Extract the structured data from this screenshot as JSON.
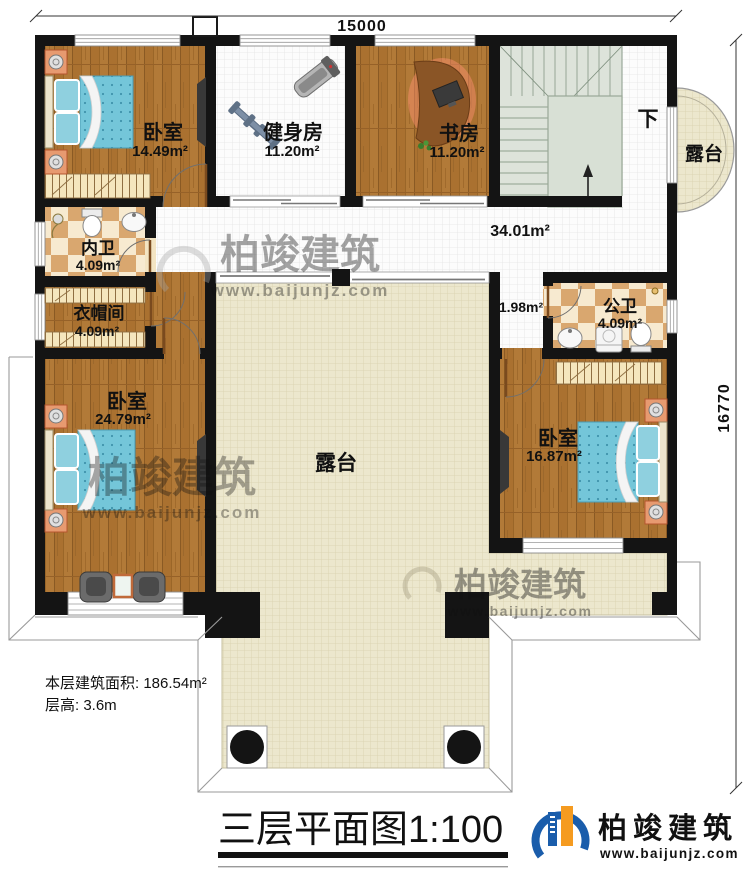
{
  "dims": {
    "top": "15000",
    "right": "16770"
  },
  "rooms": [
    {
      "id": "bedroom-top-left",
      "name": "卧室",
      "area": "14.49m²"
    },
    {
      "id": "gym",
      "name": "健身房",
      "area": "11.20m²"
    },
    {
      "id": "study",
      "name": "书房",
      "area": "11.20m²"
    },
    {
      "id": "inner-bath",
      "name": "内卫",
      "area": "4.09m²"
    },
    {
      "id": "cloakroom",
      "name": "衣帽间",
      "area": "4.09m²"
    },
    {
      "id": "bedroom-bottom-left",
      "name": "卧室",
      "area": "24.79m²"
    },
    {
      "id": "public-bath",
      "name": "公卫",
      "area": "4.09m²"
    },
    {
      "id": "bedroom-bottom-right",
      "name": "卧室",
      "area": "16.87m²"
    }
  ],
  "labels": {
    "corridor_area": "34.01m²",
    "vestibule_area": "1.98m²",
    "terrace_right": "露台",
    "terrace_center": "露台",
    "stairs_down": "下"
  },
  "info": {
    "line1": "本层建筑面积: 186.54m²",
    "line2": "层高: 3.6m"
  },
  "title": {
    "full": "三层平面图1:100"
  },
  "brand": {
    "name": "柏竣建筑",
    "url": "www.baijunjz.com"
  },
  "watermark": {
    "name": "柏竣建筑",
    "url": "www.baijunjz.com"
  },
  "colors": {
    "wall": "#141414",
    "wood": "#aa7130",
    "tile_white": "#fcfcfc",
    "tile_beige": "#ece7cd",
    "stair": "#dde3da",
    "bath_checker_dark": "#d9a76f",
    "bath_checker_light": "#f7ead0",
    "bed_blue": "#74c6d9",
    "brand_blue": "#1a5dab",
    "brand_orange": "#f59b20"
  }
}
